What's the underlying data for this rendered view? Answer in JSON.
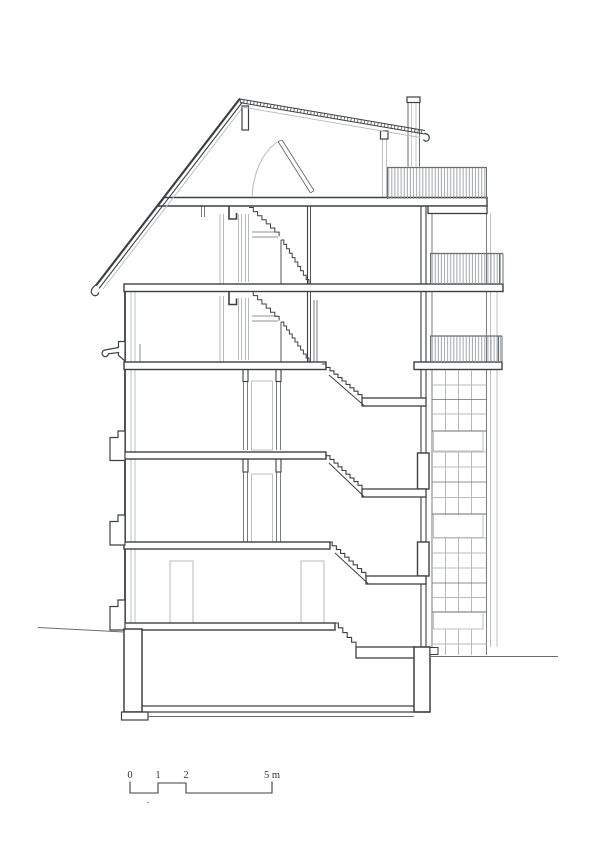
{
  "drawing": {
    "type": "architectural-cross-section",
    "subject": "multi-storey house section with pitched roof, central stair, split-level rear landings, balconies and glazed rear facade",
    "storeys_above_ground": 5,
    "has_basement": true
  },
  "scale_bar": {
    "labels": [
      "0",
      "1",
      "2",
      "5 m"
    ],
    "unit": "m"
  },
  "colors": {
    "background": "#ffffff",
    "line_dark": "#3d4043",
    "line_medium": "#6a6e71",
    "line_light": "#b4babd",
    "hatch": "#979da0"
  }
}
